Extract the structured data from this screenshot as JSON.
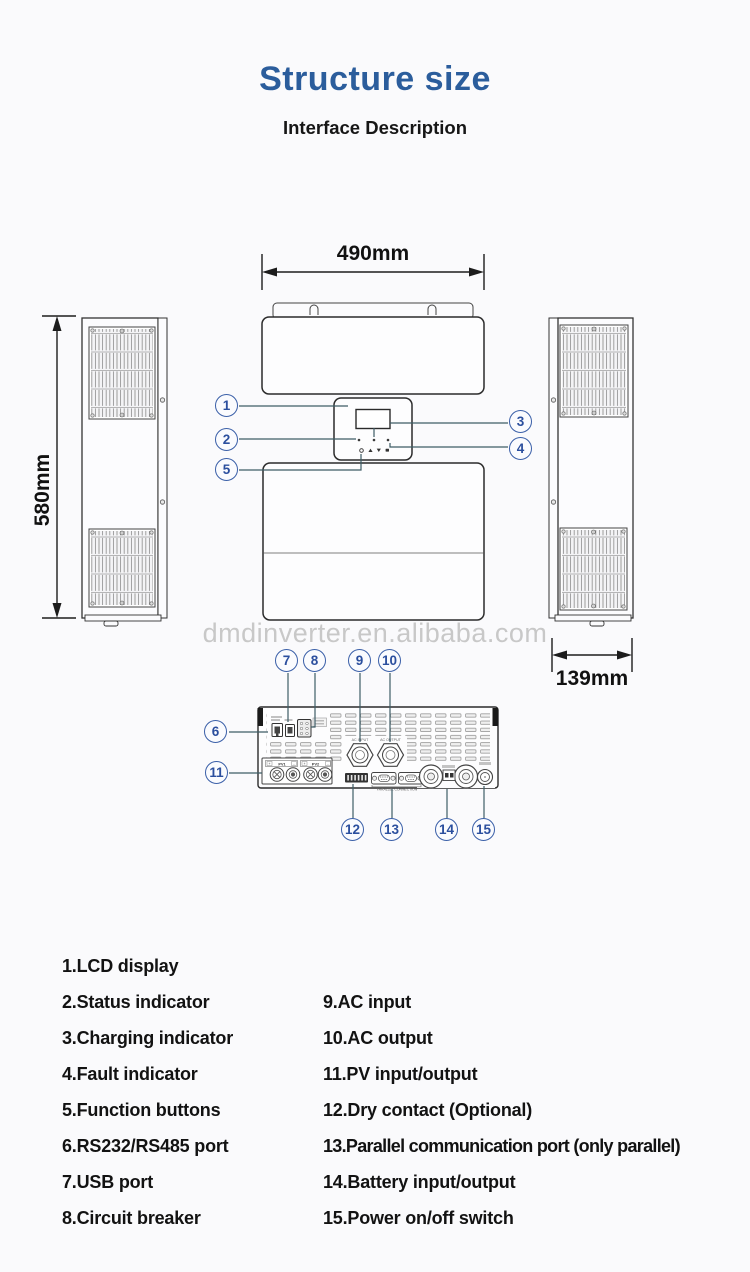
{
  "header": {
    "title": "Structure size",
    "subtitle": "Interface Description"
  },
  "watermark": "dmdinverter.en.alibaba.com",
  "dimensions": {
    "front_width": "490mm",
    "side_height": "580mm",
    "side_depth": "139mm"
  },
  "callouts": [
    "1",
    "2",
    "3",
    "4",
    "5",
    "6",
    "7",
    "8",
    "9",
    "10",
    "11",
    "12",
    "13",
    "14",
    "15"
  ],
  "port_labels": {
    "ac_input": "AC INPUT",
    "ac_output": "AC OUTPUT",
    "pv1": "PV1",
    "pv2": "PV2",
    "pv_plus": "+",
    "pv_minus": "-",
    "parallel": "PARALLEL CONNECTION"
  },
  "legend": {
    "left": [
      "1.LCD display",
      "2.Status indicator",
      "3.Charging indicator",
      "4.Fault indicator",
      "5.Function buttons",
      "6.RS232/RS485 port",
      "7.USB port",
      "8.Circuit breaker"
    ],
    "right": [
      "9.AC input",
      "10.AC output",
      "11.PV input/output",
      "12.Dry contact (Optional)",
      "13.Parallel communication port (only parallel)",
      "14.Battery input/output",
      "15.Power on/off switch"
    ]
  },
  "colors": {
    "title_blue": "#2b5d9c",
    "callout_blue": "#3a5fa8",
    "outline_dark": "#2d2d2d",
    "callout_line": "#3e5d66",
    "watermark_gray": "#c8c8c8"
  }
}
